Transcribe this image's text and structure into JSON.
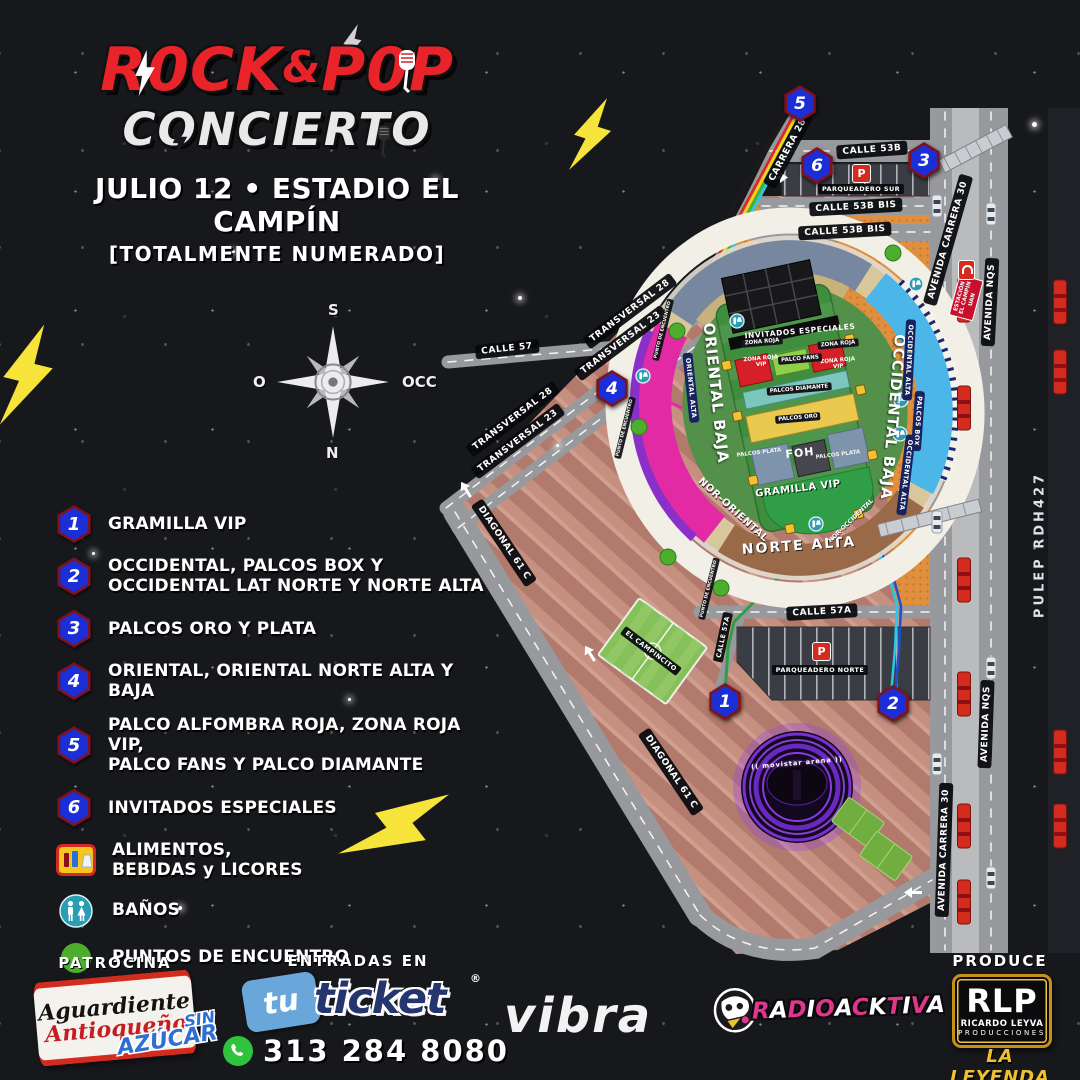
{
  "header": {
    "title_main": "ROCK&POP",
    "title_rock": "R0CK",
    "title_amp": "&",
    "title_pop": "P0P",
    "subtitle": "CONCIERTO",
    "date_venue": "JULIO 12 • ESTADIO EL CAMPÍN",
    "note": "[TOTALMENTE NUMERADO]"
  },
  "compass": {
    "top": "S",
    "left": "O",
    "right": "OCC",
    "bottom": "N"
  },
  "legend": {
    "numbered": [
      {
        "num": "1",
        "label": "GRAMILLA VIP"
      },
      {
        "num": "2",
        "label": "OCCIDENTAL, PALCOS BOX Y\nOCCIDENTAL LAT NORTE Y NORTE ALTA"
      },
      {
        "num": "3",
        "label": "PALCOS ORO Y PLATA"
      },
      {
        "num": "4",
        "label": "ORIENTAL, ORIENTAL NORTE ALTA Y BAJA"
      },
      {
        "num": "5",
        "label": "PALCO ALFOMBRA ROJA, ZONA ROJA VIP,\nPALCO FANS Y PALCO DIAMANTE"
      },
      {
        "num": "6",
        "label": "INVITADOS ESPECIALES"
      }
    ],
    "services": [
      {
        "icon": "food-icon",
        "label": "ALIMENTOS,\nBEBIDAS y LICORES"
      },
      {
        "icon": "restroom-icon",
        "label": "BAÑOS"
      },
      {
        "icon": "meeting-point-icon",
        "label": "PUNTOS DE ENCUENTRO"
      }
    ]
  },
  "map": {
    "street_labels": [
      {
        "t": "CALLE 53B",
        "x": 872,
        "y": 150,
        "r": -4
      },
      {
        "t": "CALLE 53B BIS",
        "x": 856,
        "y": 207,
        "r": -3
      },
      {
        "t": "CALLE 53B BIS",
        "x": 845,
        "y": 231,
        "r": -3
      },
      {
        "t": "PARQUEADERO SUR",
        "x": 861,
        "y": 189,
        "r": 0,
        "c": "micro"
      },
      {
        "t": "CARRERA 28",
        "x": 788,
        "y": 150,
        "r": -62
      },
      {
        "t": "AVENIDA CARRERA 30",
        "x": 948,
        "y": 240,
        "r": -74
      },
      {
        "t": "AVENIDA NQS",
        "x": 990,
        "y": 302,
        "r": -87
      },
      {
        "t": "CALLE 57",
        "x": 507,
        "y": 349,
        "r": -6
      },
      {
        "t": "TRANSVERSAL 28",
        "x": 630,
        "y": 311,
        "r": -37
      },
      {
        "t": "TRANSVERSAL 23",
        "x": 621,
        "y": 343,
        "r": -37
      },
      {
        "t": "TRANSVERSAL 28",
        "x": 513,
        "y": 419,
        "r": -37
      },
      {
        "t": "TRANSVERSAL 23",
        "x": 518,
        "y": 441,
        "r": -37
      },
      {
        "t": "DIAGONAL 61 C",
        "x": 504,
        "y": 543,
        "r": 56
      },
      {
        "t": "DIAGONAL 61 C",
        "x": 671,
        "y": 772,
        "r": 56
      },
      {
        "t": "CALLE 57A",
        "x": 822,
        "y": 612,
        "r": -3
      },
      {
        "t": "CALLE 57A",
        "x": 723,
        "y": 637,
        "r": -78,
        "c": "micro"
      },
      {
        "t": "PARQUEADERO NORTE",
        "x": 820,
        "y": 670,
        "r": 0,
        "c": "micro"
      },
      {
        "t": "AVENIDA NQS",
        "x": 986,
        "y": 724,
        "r": -88
      },
      {
        "t": "AVENIDA CARRERA 30",
        "x": 944,
        "y": 850,
        "r": -88
      },
      {
        "t": "PULEP RDH427",
        "x": 1040,
        "y": 545,
        "r": -90,
        "c": "plain"
      },
      {
        "t": "EL CAMPINCITO",
        "x": 651,
        "y": 651,
        "r": 37,
        "c": "micro"
      },
      {
        "t": "PUNTO DE ENCUENTRO",
        "x": 663,
        "y": 330,
        "r": -76,
        "c": "nano"
      },
      {
        "t": "PUNTO DE ENCUENTRO",
        "x": 709,
        "y": 589,
        "r": -76,
        "c": "nano"
      },
      {
        "t": "PUNTO DE ENCUENTRO",
        "x": 625,
        "y": 428,
        "r": -76,
        "c": "nano"
      }
    ],
    "stadium_labels": [
      {
        "t": "ORIENTAL BAJA",
        "x": 716,
        "y": 393,
        "r": 84,
        "c": "big"
      },
      {
        "t": "ORIENTAL ALTA",
        "x": 691,
        "y": 388,
        "r": 84,
        "c": "navy"
      },
      {
        "t": "OCCIDENTAL BAJA",
        "x": 893,
        "y": 417,
        "r": 95,
        "c": "big"
      },
      {
        "t": "OCCIDENTAL ALTA",
        "x": 909,
        "y": 360,
        "r": 93,
        "c": "navy"
      },
      {
        "t": "PALCOS BOX",
        "x": 918,
        "y": 421,
        "r": 94,
        "c": "navy"
      },
      {
        "t": "OCCIDENTAL ALTA",
        "x": 906,
        "y": 475,
        "r": 97,
        "c": "navy"
      },
      {
        "t": "NOR-ORIENTAL",
        "x": 733,
        "y": 510,
        "r": 42,
        "c": "mid"
      },
      {
        "t": "NORTE ALTA",
        "x": 799,
        "y": 546,
        "r": -4,
        "c": "mid-lg"
      },
      {
        "t": "NOR-OCCIDENTAL",
        "x": 851,
        "y": 521,
        "r": -44,
        "c": "small"
      },
      {
        "t": "INVITADOS ESPECIALES",
        "x": 800,
        "y": 331,
        "r": -5,
        "c": "band"
      },
      {
        "t": "ZONA ROJA",
        "x": 762,
        "y": 342,
        "r": -5,
        "c": "nanodark"
      },
      {
        "t": "ZONA ROJA",
        "x": 838,
        "y": 344,
        "r": -5,
        "c": "nanodark"
      },
      {
        "t": "ZONA ROJA\nVIP",
        "x": 761,
        "y": 362,
        "r": -5,
        "c": "redzone"
      },
      {
        "t": "ZONA ROJA\nVIP",
        "x": 838,
        "y": 364,
        "r": -5,
        "c": "redzone"
      },
      {
        "t": "PALCO FANS",
        "x": 800,
        "y": 359,
        "r": -5,
        "c": "nanodark"
      },
      {
        "t": "PALCOS DIAMANTE",
        "x": 799,
        "y": 389,
        "r": -5,
        "c": "nanodark"
      },
      {
        "t": "PALCOS ORO",
        "x": 798,
        "y": 418,
        "r": -5,
        "c": "nanodark"
      },
      {
        "t": "PALCOS PLATA",
        "x": 759,
        "y": 453,
        "r": -7,
        "c": "nanoplain"
      },
      {
        "t": "FOH",
        "x": 800,
        "y": 453,
        "r": -6,
        "c": "foh"
      },
      {
        "t": "PALCOS PLATA",
        "x": 838,
        "y": 455,
        "r": -7,
        "c": "nanoplain"
      },
      {
        "t": "GRAMILLA VIP",
        "x": 798,
        "y": 489,
        "r": -7,
        "c": "mid"
      },
      {
        "t": "(( movistar arena ))",
        "x": 797,
        "y": 763,
        "r": -5,
        "c": "arena"
      }
    ],
    "entrance_badges": [
      {
        "n": "5",
        "x": 800,
        "y": 103
      },
      {
        "n": "6",
        "x": 817,
        "y": 165
      },
      {
        "n": "3",
        "x": 924,
        "y": 160
      },
      {
        "n": "4",
        "x": 612,
        "y": 388
      },
      {
        "n": "1",
        "x": 725,
        "y": 701
      },
      {
        "n": "2",
        "x": 893,
        "y": 703
      }
    ],
    "station_label": "ESTACIÓN\nEL CAMPÍN\nUAN",
    "parking_letter": "P"
  },
  "footer": {
    "patrocina": "PATROCINA",
    "aguardiente_line1": "Aguardiente",
    "aguardiente_line2": "Antioqueño",
    "sin": "SIN",
    "azucar": "AZÚCAR",
    "entradas": "ENTRADAS EN",
    "ticket_tu": "tu",
    "ticket_word": "ticket",
    "ticket_reg": "®",
    "phone": "313 284 8080",
    "vibra": "vibra",
    "radio": "RADIOACKTIVA",
    "produce": "PRODUCE",
    "rlp": "RLP",
    "rlp_name": "RICARDO LEYVA",
    "rlp_sub": "PRODUCCIONES",
    "rlp_tag": "LA LEYENDA"
  },
  "colors": {
    "accent_red": "#e8232a",
    "badge_blue": "#1c2fd6",
    "transmilenio_red": "#d42b1f",
    "gold": "#f0c030",
    "lightning_yellow": "#f6e43a"
  }
}
